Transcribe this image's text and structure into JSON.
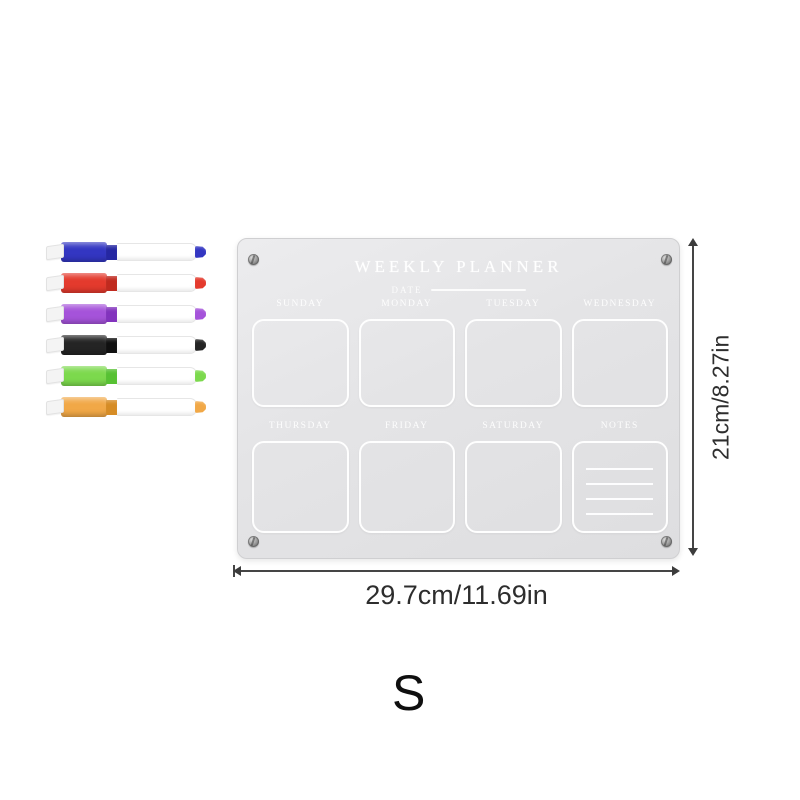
{
  "board": {
    "title": "WEEKLY PLANNER",
    "date_label": "DATE",
    "day_cells_row1": [
      "SUNDAY",
      "MONDAY",
      "TUESDAY",
      "WEDNESDAY"
    ],
    "day_cells_row2": [
      "THURSDAY",
      "FRIDAY",
      "SATURDAY",
      "NOTES"
    ],
    "notes_lines_count": 5
  },
  "markers": [
    {
      "name": "blue-marker",
      "cap_color": "#3336c2",
      "trim_color": "#2527a2"
    },
    {
      "name": "red-marker",
      "cap_color": "#e43a2d",
      "trim_color": "#c02a1f"
    },
    {
      "name": "purple-marker",
      "cap_color": "#a553da",
      "trim_color": "#8233bd"
    },
    {
      "name": "black-marker",
      "cap_color": "#242424",
      "trim_color": "#101010"
    },
    {
      "name": "green-marker",
      "cap_color": "#7cd94d",
      "trim_color": "#57c133"
    },
    {
      "name": "orange-marker",
      "cap_color": "#f1a847",
      "trim_color": "#d68c25"
    }
  ],
  "dimensions": {
    "width_label": "29.7cm/11.69in",
    "height_label": "21cm/8.27in"
  },
  "watermark": "S"
}
